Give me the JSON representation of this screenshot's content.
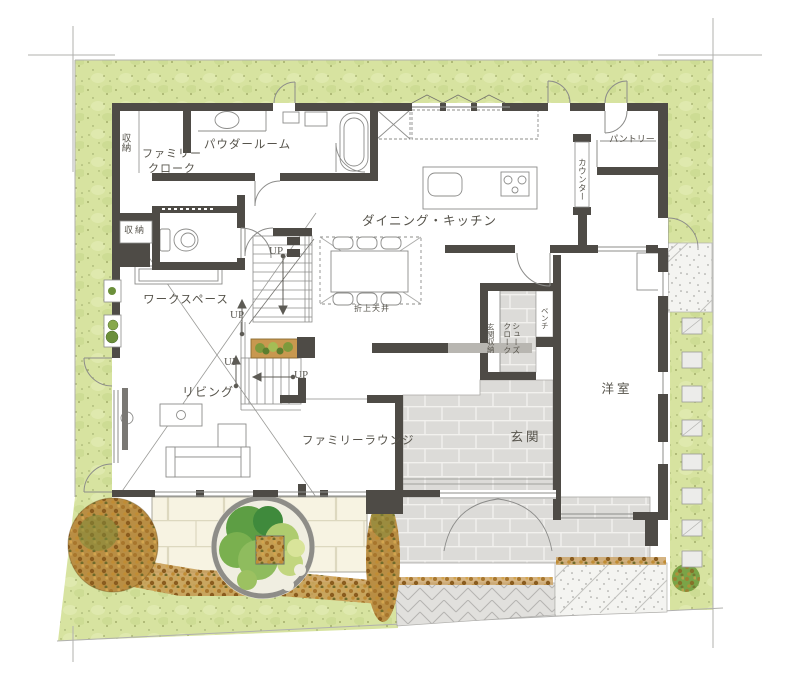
{
  "labels": {
    "storage_top": "収納",
    "family_cloak_line1": "ファミリー",
    "family_cloak_line2": "クローク",
    "powder_room": "パウダールーム",
    "pantry": "パントリー",
    "counter": "カウンター",
    "dining_kitchen": "ダイニング・キッチン",
    "coffered_ceiling": "折上天井",
    "up": "UP",
    "workspace": "ワークスペース",
    "storage_wc": "収納",
    "living": "リビング",
    "family_lounge": "ファミリーラウンジ",
    "entrance": "玄関",
    "bench": "ベンチ",
    "shoes_closet_line1": "シューズ",
    "shoes_closet_line2": "クローク",
    "entrance_storage": "玄関収納",
    "western_room": "洋室"
  },
  "colors": {
    "wall": "#4e4b46",
    "lawn": "#d7e3a0",
    "terrace_tile": "#f7f3e2",
    "entrance_tile": "#dcdbd8",
    "shrub": "#c69a52",
    "stair_planter": "#c8984f",
    "tree_green": "#5d9e44",
    "line": "#8c8c8a"
  }
}
